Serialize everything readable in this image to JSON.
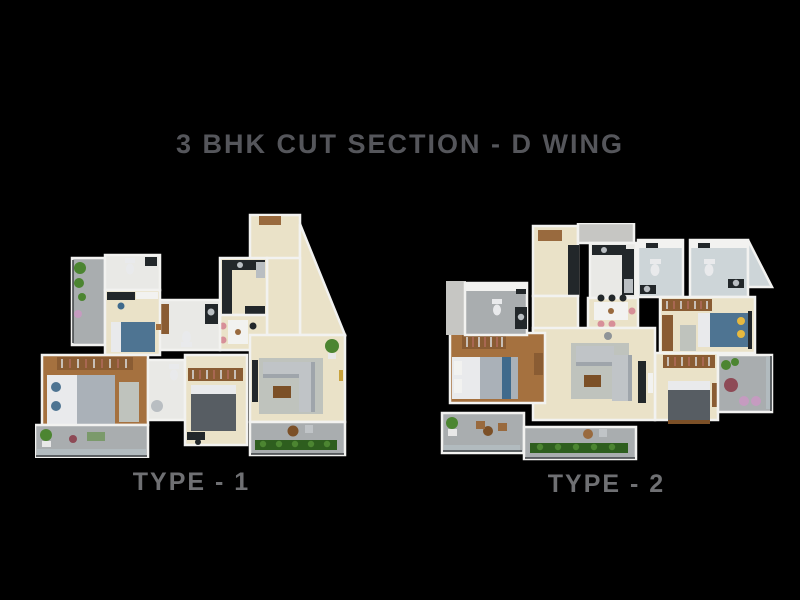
{
  "title": {
    "text": "3 BHK CUT SECTION - D WING"
  },
  "plans": [
    {
      "label": "TYPE - 1"
    },
    {
      "label": "TYPE - 2"
    }
  ],
  "palette": {
    "bg": "#000000",
    "title_color": "#55565b",
    "label_color": "#6f7073",
    "floor": "#eae2c8",
    "tile": "#e9e9e6",
    "tile_blue": "#cdd5d8",
    "wall": "#f2f2f0",
    "wall_side": "#c6c6c3",
    "wood": "#a5713f",
    "wood_dark": "#7c5027",
    "wardrobe": "#8a5c33",
    "counter_dark": "#22272a",
    "steel": "#b9bec2",
    "sofa": "#c0c4c7",
    "sofa_shadow": "#9fa5ab",
    "bed_white": "#e9eaec",
    "bed_gray": "#aab1b8",
    "bed_charcoal": "#575d63",
    "bed_blue": "#4e7492",
    "throw_blue": "#3f6a8c",
    "pillow_yellow": "#e7b93f",
    "balcony": "#a9adaf",
    "green": "#4c8531",
    "green_dark": "#2e5e1e",
    "door": "#996a3e",
    "chair_pink": "#d78f98",
    "chair_green": "#7b9a6b",
    "rug": "#bfc3bd",
    "pouf_maroon": "#8e4a56",
    "pouf_pink": "#c59bc0",
    "glass": "#b7c3c8",
    "lamp": "#8f9498",
    "pot": "#e8e8e8",
    "gold": "#c8a23c",
    "railing": "#3c4043",
    "clothes_a": "#d8d8d8",
    "clothes_b": "#b06a5a"
  }
}
